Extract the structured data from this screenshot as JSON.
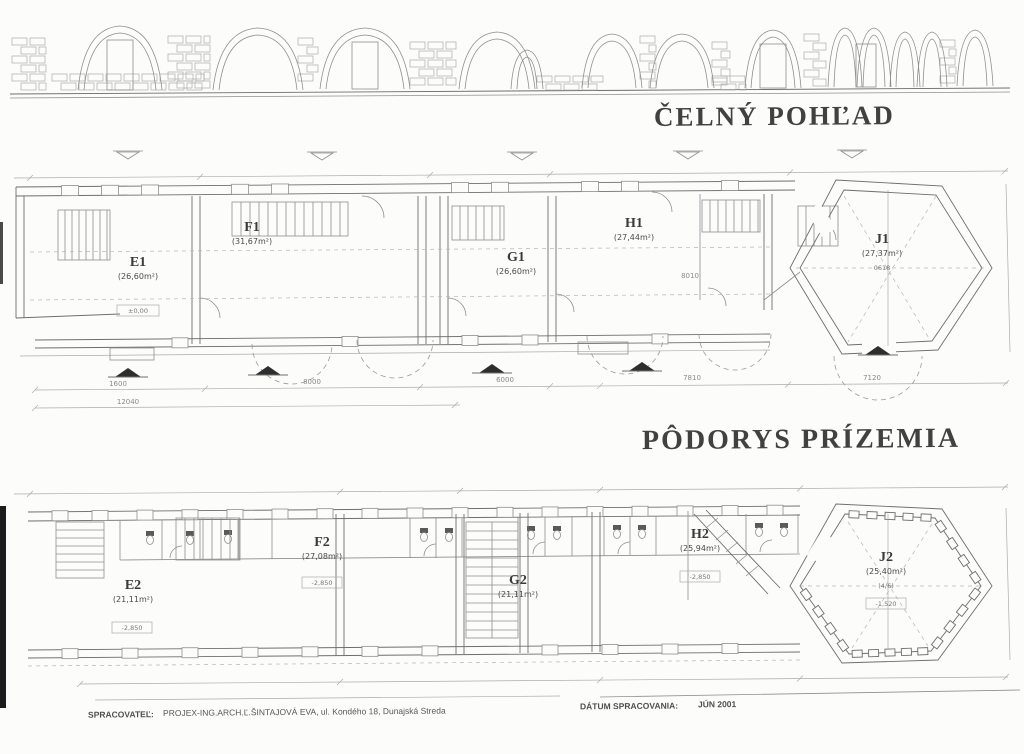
{
  "elevation": {
    "title": "ČELNÝ POHĽAD"
  },
  "ground_plan_title": "PÔDORYS PRÍZEMIA",
  "upper_plan": {
    "rooms": [
      {
        "id": "E1",
        "area": "(26,60m²)",
        "level": "±0,00"
      },
      {
        "id": "F1",
        "area": "(31,67m²)"
      },
      {
        "id": "G1",
        "area": "(26,60m²)"
      },
      {
        "id": "H1",
        "area": "(27,44m²)"
      },
      {
        "id": "J1",
        "area": "(27,37m²)",
        "note": "0618"
      }
    ],
    "dimensions": {
      "d1": "1600",
      "d2": "8000",
      "d3": "6000",
      "d4": "7810",
      "d5": "7120",
      "total": "12040",
      "right": "8010"
    }
  },
  "lower_plan": {
    "rooms": [
      {
        "id": "E2",
        "area": "(21,11m²)",
        "level": "-2,850"
      },
      {
        "id": "F2",
        "area": "(27,08m²)",
        "level": "-2,850"
      },
      {
        "id": "G2",
        "area": "(21,11m²)"
      },
      {
        "id": "H2",
        "area": "(25,94m²)",
        "level": "-2,850"
      },
      {
        "id": "J2",
        "area": "(25,40m²)",
        "note": "(4/6)",
        "level": "-1,520"
      }
    ]
  },
  "footer": {
    "author_label": "SPRACOVATEĽ:",
    "author": "PROJEX-ING.ARCH.Ľ.ŠINTAJOVÁ EVA, ul. Kondého 18, Dunajská Streda",
    "date_label": "DÁTUM SPRACOVANIA:",
    "date": "JÚN 2001"
  }
}
